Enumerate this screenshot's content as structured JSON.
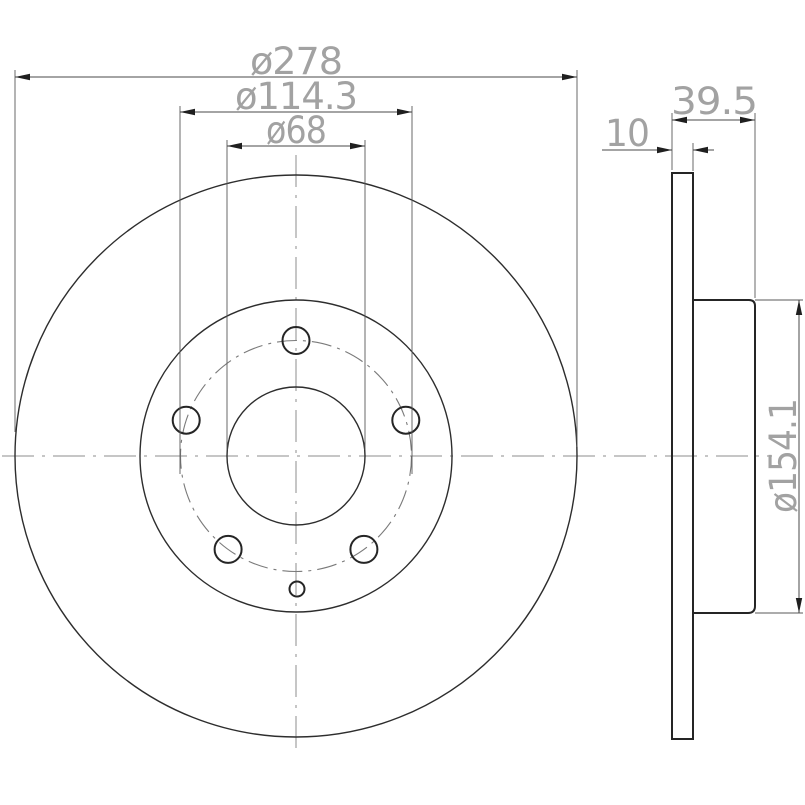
{
  "drawing": {
    "type": "brake-disc-technical-drawing",
    "views": {
      "front": "front-view",
      "side": "side-cross-section-view"
    },
    "dimensions": {
      "outer_diameter": "ø278",
      "bolt_circle": "ø114.3",
      "center_bore": "ø68",
      "overall_width": "39.5",
      "thickness": "10",
      "hub_diameter": "ø154.1"
    },
    "features": {
      "bolt_hole_count": 5,
      "locating_hole_count": 1
    },
    "colors": {
      "background": "#ffffff",
      "geometry_line": "#2d2d2d",
      "dimension_line": "#4a4a4a",
      "centerline": "#8c8c8c",
      "dimension_text": "#a2a2a2"
    }
  }
}
